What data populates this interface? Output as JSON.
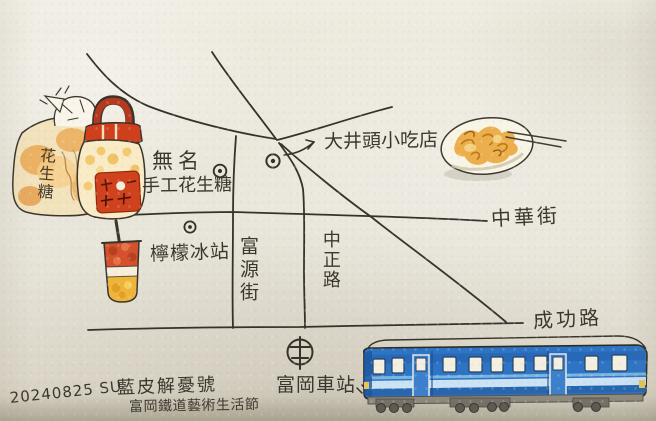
{
  "scene": {
    "description": "Hand-drawn watercolor town map photographed on textured paper",
    "paper_color": "#e8e5da",
    "ink_color": "#36322a"
  },
  "streets": {
    "zhonghua": "中華街",
    "fuyuan": "富源街",
    "zhongzheng": "中正路",
    "chenggong": "成功路"
  },
  "places": {
    "peanut_line1": "無名",
    "peanut_line2": "手工花生糖",
    "snack_shop": "大井頭小吃店",
    "lemon_ice": "檸檬冰站",
    "train_station": "富岡車站"
  },
  "caption": {
    "date": "20240825 SU",
    "line1": "藍皮解憂號",
    "line2": "富岡鐵道藝術生活節"
  },
  "illustrations": {
    "bag_text": "花生糖",
    "items": [
      "peanut-candy-bag",
      "candy-jar",
      "snack-dish-with-chopsticks",
      "lemon-drink-cup",
      "blue-train",
      "train-station-symbol",
      "poi-dot-markers"
    ]
  },
  "colors": {
    "train_blue": "#2e74c4",
    "train_stripe": "#d9edf7",
    "jar_red": "#cf3f1c",
    "candy_orange": "#eaa54d",
    "drink_red": "#d5512e",
    "drink_yellow": "#efb53a",
    "dish_orange": "#eaa83f"
  }
}
